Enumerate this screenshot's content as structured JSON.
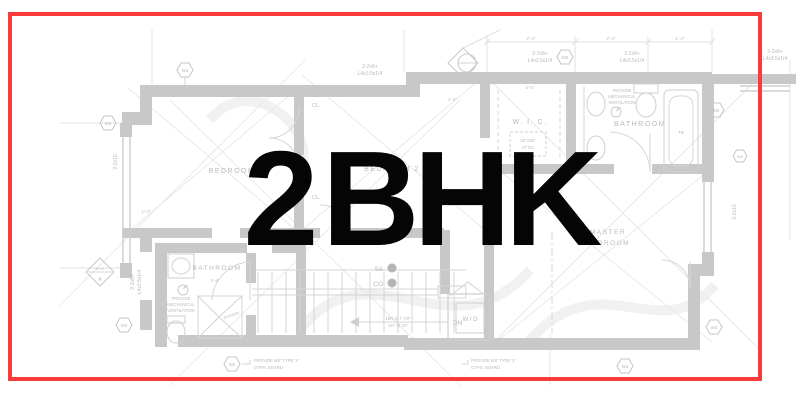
{
  "overlay": {
    "title": "2 BHK"
  },
  "colors": {
    "frame_red": "#f93b3b",
    "title_ink": "#050505",
    "plan_wall": "#c8c8c8",
    "plan_line": "#d6d6d6",
    "plan_text": "#b9b9b9"
  },
  "plan": {
    "rooms": {
      "bedroom": "BEDROOM",
      "bedroom2": "BEDROOM 2",
      "wic": "W. I. C.",
      "bathroom_upper": "BATHROOM",
      "bathroom_lower": "BATHROOM",
      "master1": "MASTER",
      "master2": "BEDROOM",
      "wd": "W / D",
      "closet": "CL.",
      "shower": "SHOWER"
    },
    "stairs": {
      "dn": "DN",
      "note1": "16R @ 7 7/8\"",
      "note2": "15T @ 10\"",
      "sa": "SA",
      "co": "CO"
    },
    "notes": {
      "vent1": "PROVIDE",
      "vent2": "MECHANICAL",
      "vent3": "VENTILATION",
      "gyps1": "PROVIDE 5/8\" TYPE 'X'",
      "gyps2": "GYPS. BOARD"
    },
    "attic": {
      "line1": "22\"x30\"",
      "line2": "ATTIC"
    },
    "beams": {
      "b1": "2-2x8+",
      "b2": "L4x3.5x1/4",
      "lumber": "2-2x10"
    },
    "dims": {
      "d24": "2'-4\"",
      "d44": "4'-4\"",
      "d14": "1'-4\""
    },
    "tags": {
      "w2": "W2",
      "w3": "W3",
      "w4": "W4",
      "w5": "W5",
      "w6": "W6"
    },
    "markers": {
      "section": "A",
      "detail": "A-10",
      "tb": "TB"
    }
  }
}
